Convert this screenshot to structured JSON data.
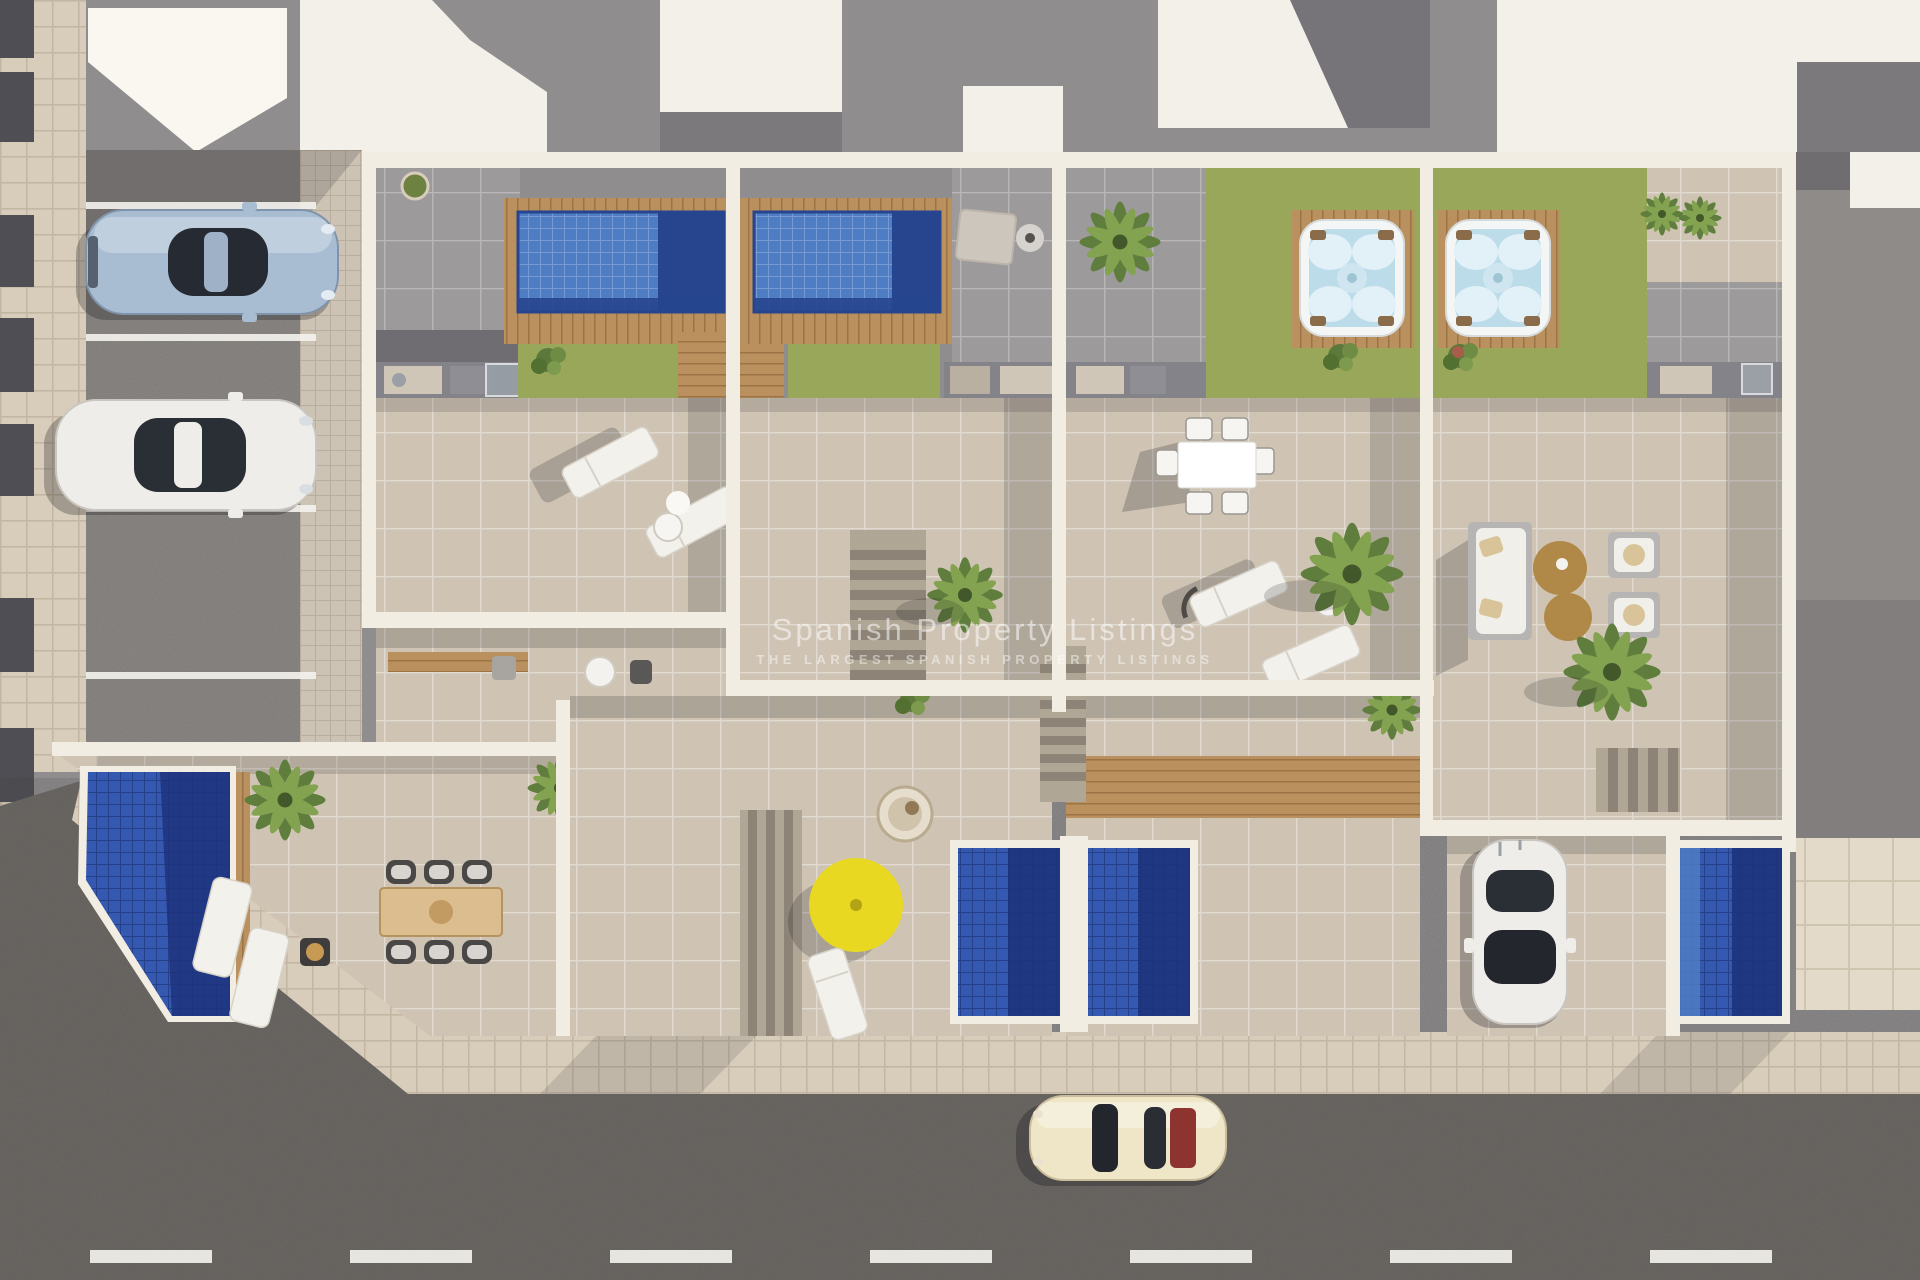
{
  "meta": {
    "title": "Aerial top-down 3D render of a modern townhouse development",
    "type": "architectural-render"
  },
  "watermark": {
    "title": "Spanish Property Listings",
    "subtitle": "THE LARGEST SPANISH PROPERTY LISTINGS"
  },
  "palette": {
    "street": "#6e6a66",
    "parking": "#8d8986",
    "sidewalk": "#d8cdbb",
    "sidewalk_line": "#c3b7a4",
    "wall": "#f2ede2",
    "wall_bright": "#faf7f0",
    "roof_gray": "#8f8d8e",
    "roof_gray_dark": "#787679",
    "roof_white": "#f3f0ea",
    "tile_gray": "#9c9a9b",
    "tile_beige": "#cfc4b4",
    "tile_beige_light": "#d9cfc1",
    "lawn": "#98a75a",
    "lawn_dark": "#6d8140",
    "deck_wood": "#b9905e",
    "deck_wood_dark": "#9a7347",
    "pool_light": "#4f7dc4",
    "pool_dark": "#27458f",
    "pool_ground": "#3558b0",
    "pool_ground_dark": "#1d337c",
    "hot_tub_water": "#bcdcea",
    "hot_tub_shell": "#f4f6f6",
    "umbrella_yellow": "#e8d821",
    "table_brown": "#b08948",
    "car_blue": "#a8bdd2",
    "car_white": "#efedea",
    "car_cream": "#efe6c8",
    "car_red_accent": "#8e3430"
  },
  "scene": {
    "setting": "Top-down aerial render of four modern townhouses with roof terraces, two rooftop pools, two hot tubs on timber decks, lawns, ground-level plunge pools, a corner garden pool with dining set, parking bays with two cars, a driveway with a parked car and a street with a cream classic car",
    "units_count": 4,
    "features": [
      "rooftop pool with wooden deck (unit 1)",
      "rooftop pool with wooden deck (unit 2)",
      "hot tub on timber deck with lawn (unit 3)",
      "hot tub on timber deck with lawn (unit 4)",
      "ground-level plunge pools",
      "corner garden pool with wooden dining table",
      "sun loungers and outdoor lounge furniture",
      "yellow parasol",
      "street with dashed lane markings",
      "parking bays",
      "private driveway"
    ],
    "vehicles": [
      {
        "name": "silver-blue sports car",
        "location": "parking bay, top left"
      },
      {
        "name": "white sedan",
        "location": "parking bay, left"
      },
      {
        "name": "white hatchback",
        "location": "driveway, bottom right"
      },
      {
        "name": "cream classic coupe",
        "location": "street, bottom"
      }
    ]
  }
}
